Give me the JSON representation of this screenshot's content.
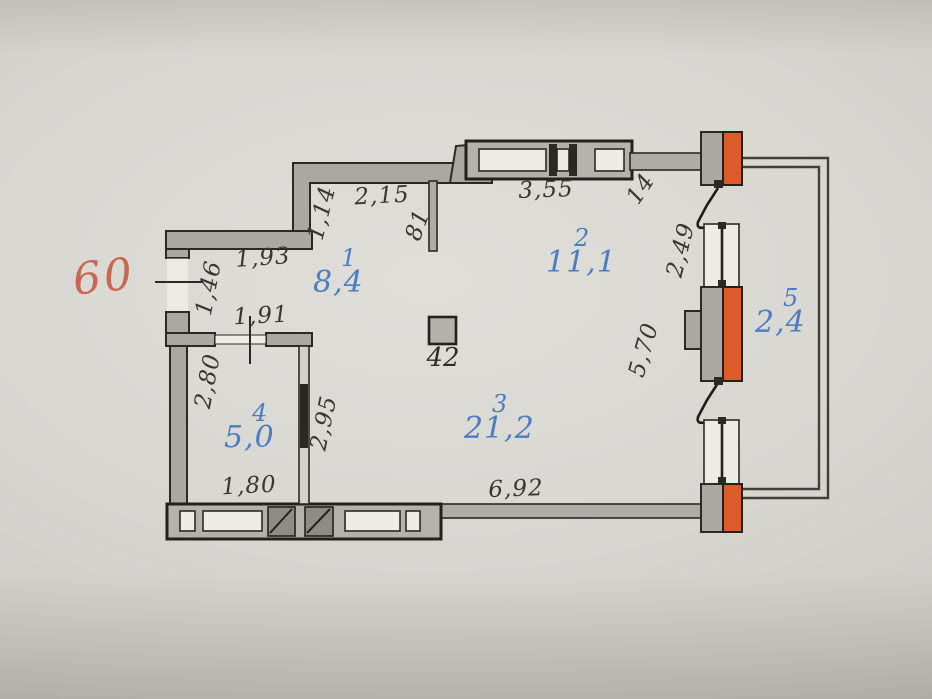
{
  "apartment_number": "60",
  "rooms": [
    {
      "number": "1",
      "area": "8,4"
    },
    {
      "number": "2",
      "area": "11,1"
    },
    {
      "number": "3",
      "area": "21,2"
    },
    {
      "number": "4",
      "area": "5,0"
    },
    {
      "number": "5",
      "area": "2,4"
    }
  ],
  "shaft": {
    "label": "42"
  },
  "dimensions": {
    "d1_14": "1,14",
    "d2_15": "2,15",
    "d81": "81",
    "d3_55": "3,55",
    "d14": "14",
    "d2_49": "2,49",
    "d1_93": "1,93",
    "d1_46": "1,46",
    "d1_91": "1,91",
    "d2_80": "2,80",
    "d2_95": "2,95",
    "d5_70": "5,70",
    "d1_80": "1,80",
    "d6_92": "6,92"
  },
  "colors": {
    "accent_orange": "#dd5a2b",
    "room_label_blue": "#4a7dc2",
    "apartment_number_red": "#c8664f"
  }
}
